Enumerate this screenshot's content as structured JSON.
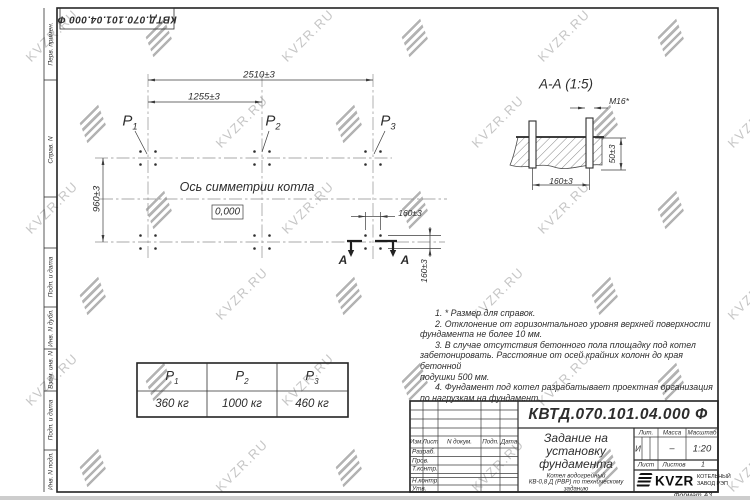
{
  "watermark": {
    "text": "KVZR.RU"
  },
  "colors": {
    "line": "#2f2f2f",
    "watermark_text": "#c6c6c6",
    "watermark_logo": "#b3b3b3"
  },
  "top_stamp": {
    "doc_number": "КВТД.070.101.04.000  Ф"
  },
  "margin_labels": {
    "perv_primen": "Перв. примен.",
    "sprav_n": "Справ. N",
    "podp_i_data_1": "Подп. и дата",
    "inv_n_dubl": "Инв. N дубл.",
    "vzam_inv_n": "Взам. инв. N",
    "podp_i_data_2": "Подп. и дата",
    "inv_n_podl": "Инв. N подл."
  },
  "plan": {
    "dim_2510": "2510±3",
    "dim_1255": "1255±3",
    "dim_960": "960±3",
    "dim_160_h": "160±3",
    "dim_160_v": "160±3",
    "axis_label": "Ось симметрии котла",
    "level_mark": "0,000",
    "section_letter": "А"
  },
  "section_view": {
    "title": "А-А (1:5)",
    "thread_label": "М16*",
    "dim_50": "50±3",
    "dim_160": "160±3"
  },
  "notes": {
    "lines": [
      "1.  * Размер для справок.",
      "2.  Отклонение от горизонтального уровня верхней поверхности",
      "фундамента не более 10 мм.",
      "3.  В случае отсутствия бетонного пола площадку под котел",
      "забетонировать. Расстояние от осей крайних колонн до края бетонной",
      "подушки 500 мм.",
      "4.  Фундамент под котел разрабатывает проектная организация",
      "по нагрузкам на фундамент."
    ]
  },
  "load_table": {
    "columns": [
      {
        "sym": "P",
        "sub": "1",
        "value": "360 кг"
      },
      {
        "sym": "P",
        "sub": "2",
        "value": "1000 кг"
      },
      {
        "sym": "P",
        "sub": "3",
        "value": "460 кг"
      }
    ]
  },
  "title_block": {
    "doc_number": "КВТД.070.101.04.000  Ф",
    "title_lines": [
      "Задание на",
      "установку",
      "фундамента"
    ],
    "subtitle_lines": [
      "Котел водогрейный",
      "КВ-0,8 Д (РВР) по техническому",
      "заданию"
    ],
    "header_row": {
      "izm": "Изм.",
      "list": "Лист",
      "ndoc": "N докум.",
      "podp": "Подп.",
      "data": "Дата"
    },
    "signature_rows": [
      "Разраб.",
      "Пров.",
      "Т.контр.",
      "Н.контр.",
      "Утв."
    ],
    "lit_label": "Лит.",
    "mass_label": "Масса",
    "scale_label": "Масштаб",
    "lit_value": "И",
    "mass_value": "–",
    "scale_value": "1:20",
    "sheet_label": "Лист",
    "sheets_label": "Листов",
    "sheets_value": "1",
    "company": {
      "name": "KVZR",
      "line1": "КОТЕЛЬНЫЙ",
      "line2": "ЗАВОД РЭП"
    },
    "format_label": "Формат А3"
  }
}
